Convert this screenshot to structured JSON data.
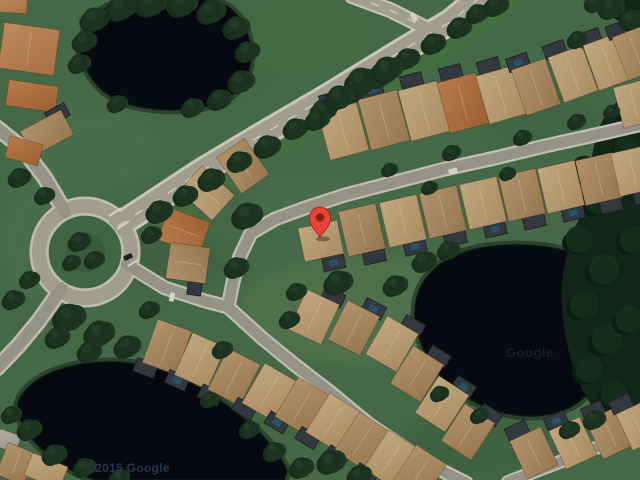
{
  "map": {
    "view_type": "satellite",
    "pin": {
      "x": 320,
      "y": 238,
      "color": "#EA4335",
      "dot_color": "#7E2217",
      "outline": "#9A2015"
    },
    "watermarks": [
      {
        "text": "©2015 Google",
        "x": 86,
        "y": 461,
        "size": 12,
        "weight": 600,
        "color": "#2b3a50",
        "opacity": 0.9,
        "ls": 0.3
      },
      {
        "text": "Google",
        "x": 506,
        "y": 345,
        "size": 13,
        "weight": 700,
        "color": "#22304a",
        "opacity": 0.55,
        "ls": 0.5
      }
    ],
    "palette": {
      "grass": "#4e7650",
      "belt": "#4a7d47",
      "water": "#070b13",
      "water_rim": "#1c2e20",
      "water_edge": "#0e1a12",
      "road_fill": "#b4b1a2",
      "road_edge": "#e0ddcf",
      "street_fill": "#a7a497",
      "street_edge": "#d6d3c5",
      "island": "#47724a",
      "island_inner": "#3f6743",
      "forest": "#142a1b",
      "tree1": "#1b3320",
      "tree2": "#224027",
      "tree3": "#1e3823",
      "tree_hi": "#2f5233",
      "forest1": "#0d2013",
      "forest2": "#122a19",
      "forest3": "#173320",
      "cage": "#383f45",
      "cage_edge": "#1f2429",
      "pool": "#2c6176",
      "car_white": "#eceade",
      "car_dark": "#23272b",
      "ridge": "rgba(255,246,224,0.3)",
      "roof_stroke": "rgba(70,45,20,0.4)",
      "marking": "#f2efe4",
      "roofs": {
        "tan": [
          "#d8bb8e",
          "#bf9d6e"
        ],
        "tan2": [
          "#c7a478",
          "#a9855a"
        ],
        "orange": [
          "#cf8a54",
          "#b06a38"
        ],
        "orange2": [
          "#d49a6a",
          "#bb7d4c"
        ],
        "pale": [
          "#c9c5b8",
          "#a9a497"
        ]
      }
    },
    "belt_path": "M 148,232 C 230,172 330,106 460,16 L 490,-2 L 524,-2 C 470,50 400,98 330,132 C 272,160 212,198 170,234 Z",
    "ponds": [
      {
        "name": "pond-northwest",
        "d": "M 80,52 C 82,24 98,6 126,1 L 210,0 C 232,4 246,20 250,44 C 253,68 246,90 222,101 C 198,112 160,112 132,105 C 106,98 88,82 80,52 Z"
      },
      {
        "name": "pond-east",
        "d": "M 419,291 C 428,268 452,252 487,247 C 522,242 562,246 590,260 C 612,272 620,295 616,322 C 612,352 604,380 582,399 C 560,418 524,420 494,410 C 462,399 436,377 424,350 C 414,327 412,310 419,291 Z"
      },
      {
        "name": "pond-southwest",
        "d": "M 20,398 C 34,374 72,361 114,362 C 158,363 200,384 238,414 C 262,433 280,453 287,471 L 284,480 L 96,480 C 62,470 38,448 27,432 C 18,419 15,408 20,398 Z"
      }
    ],
    "forest_paths": [
      "M 640,86 C 618,96 602,114 596,138 C 588,166 592,190 580,216 C 568,244 560,274 562,306 C 564,342 574,378 590,403 C 606,426 626,434 640,432 Z",
      "M 640,0 L 596,0 C 604,14 620,24 640,30 Z"
    ],
    "patches": [
      [
        90,
        150,
        70,
        40,
        "#58805a",
        0.45
      ],
      [
        165,
        262,
        60,
        32,
        "#3f6442",
        0.4
      ],
      [
        370,
        310,
        130,
        55,
        "#64885a",
        0.5
      ],
      [
        480,
        442,
        80,
        38,
        "#3c6340",
        0.4
      ],
      [
        240,
        432,
        70,
        32,
        "#47704a",
        0.4
      ],
      [
        200,
        60,
        80,
        40,
        "#49724b",
        0.4
      ],
      [
        45,
        240,
        45,
        60,
        "#5a815c",
        0.4
      ],
      [
        545,
        120,
        60,
        35,
        "#3f6b41",
        0.35
      ],
      [
        310,
        200,
        60,
        30,
        "#567e54",
        0.4
      ],
      [
        300,
        35,
        70,
        35,
        "#4d7a4b",
        0.5
      ]
    ],
    "roads": [
      {
        "name": "main-road",
        "pts": [
          [
            118,
            226
          ],
          [
            150,
            205
          ],
          [
            200,
            172
          ],
          [
            260,
            136
          ],
          [
            330,
            95
          ],
          [
            400,
            52
          ],
          [
            450,
            22
          ],
          [
            482,
            -4
          ]
        ],
        "w": 21,
        "uw": 27,
        "dash": true,
        "kind": "road"
      },
      {
        "name": "main-road-fork",
        "pts": [
          [
            352,
            -4
          ],
          [
            390,
            10
          ],
          [
            424,
            27
          ]
        ],
        "w": 12,
        "uw": 16,
        "dash": true,
        "kind": "road"
      },
      {
        "name": "northwest-road",
        "pts": [
          [
            -3,
            128
          ],
          [
            22,
            148
          ],
          [
            45,
            178
          ],
          [
            65,
            212
          ]
        ],
        "w": 12,
        "uw": 17,
        "dash": false,
        "kind": "street"
      },
      {
        "name": "southwest-road",
        "pts": [
          [
            62,
            288
          ],
          [
            38,
            322
          ],
          [
            18,
            346
          ],
          [
            -3,
            368
          ]
        ],
        "w": 12,
        "uw": 17,
        "dash": false,
        "kind": "street"
      },
      {
        "name": "east-street",
        "pts": [
          [
            126,
            264
          ],
          [
            165,
            288
          ],
          [
            205,
            301
          ],
          [
            228,
            307
          ],
          [
            262,
            338
          ],
          [
            295,
            365
          ],
          [
            330,
            392
          ],
          [
            370,
            425
          ],
          [
            410,
            452
          ],
          [
            448,
            474
          ],
          [
            466,
            483
          ]
        ],
        "w": 10.5,
        "uw": 15,
        "dash": false,
        "kind": "street"
      },
      {
        "name": "north-street",
        "pts": [
          [
            228,
            307
          ],
          [
            233,
            282
          ],
          [
            240,
            256
          ],
          [
            251,
            233
          ],
          [
            275,
            219
          ],
          [
            305,
            208
          ],
          [
            345,
            195
          ],
          [
            395,
            182
          ],
          [
            445,
            169
          ],
          [
            495,
            158
          ],
          [
            545,
            146
          ],
          [
            595,
            135
          ],
          [
            643,
            124
          ]
        ],
        "w": 10.5,
        "uw": 15,
        "dash": false,
        "kind": "street"
      },
      {
        "name": "corner-street",
        "pts": [
          [
            508,
            482
          ],
          [
            575,
            456
          ],
          [
            643,
            430
          ]
        ],
        "w": 10,
        "uw": 14,
        "dash": false,
        "kind": "street"
      }
    ],
    "roundabout": {
      "cx": 85,
      "cy": 252,
      "ring_r": 46,
      "ring_w": 14,
      "underlay_w": 19,
      "island_r": 37,
      "inner_r": 20
    },
    "crosswalks": [
      [
        109,
        216,
        121,
        208
      ],
      [
        117,
        229,
        129,
        221
      ],
      [
        128,
        266,
        138,
        260
      ]
    ],
    "houses": [
      [
        343,
        130,
        40,
        52,
        -15,
        "tan",
        -4,
        -32,
        0
      ],
      [
        384,
        120,
        40,
        52,
        -15,
        "tan2",
        -4,
        -32,
        1
      ],
      [
        424,
        111,
        40,
        52,
        -15,
        "tan",
        -4,
        -32,
        0
      ],
      [
        463,
        103,
        40,
        52,
        -15,
        "orange",
        -4,
        -32,
        0
      ],
      [
        501,
        95,
        38,
        50,
        -16,
        "tan",
        -4,
        -31,
        0
      ],
      [
        536,
        87,
        36,
        48,
        -19,
        "tan2",
        -9,
        -29,
        1
      ],
      [
        573,
        74,
        36,
        48,
        -20,
        "tan",
        -9,
        -29,
        0
      ],
      [
        608,
        62,
        36,
        48,
        -20,
        "tan",
        -9,
        -29,
        0
      ],
      [
        636,
        53,
        34,
        46,
        -21,
        "tan2",
        -9,
        -28,
        0
      ],
      [
        634,
        104,
        32,
        42,
        -15,
        "tan",
        null,
        null,
        0
      ],
      [
        321,
        241,
        40,
        34,
        -12,
        "tan",
        8,
        24,
        1
      ],
      [
        362,
        230,
        38,
        46,
        -13,
        "tan2",
        6,
        28,
        0
      ],
      [
        403,
        221,
        38,
        46,
        -13,
        "tan",
        6,
        28,
        1
      ],
      [
        443,
        212,
        38,
        46,
        -13,
        "tan2",
        6,
        28,
        0
      ],
      [
        483,
        203,
        38,
        46,
        -13,
        "tan",
        6,
        28,
        1
      ],
      [
        522,
        195,
        38,
        46,
        -13,
        "tan2",
        6,
        28,
        0
      ],
      [
        561,
        187,
        38,
        46,
        -13,
        "tan",
        6,
        28,
        1
      ],
      [
        599,
        179,
        38,
        46,
        -13,
        "tan2",
        6,
        28,
        0
      ],
      [
        633,
        171,
        36,
        44,
        -13,
        "tan",
        6,
        27,
        0
      ],
      [
        243,
        166,
        34,
        44,
        -35,
        "tan2",
        null,
        null,
        0
      ],
      [
        207,
        193,
        34,
        44,
        -48,
        "tan",
        null,
        null,
        0
      ],
      [
        184,
        231,
        34,
        44,
        -70,
        "orange",
        null,
        null,
        0
      ],
      [
        188,
        263,
        36,
        40,
        -82,
        "tan2",
        -20,
        10,
        0
      ],
      [
        314,
        317,
        36,
        44,
        25,
        "tan",
        9,
        -26,
        0
      ],
      [
        354,
        328,
        36,
        44,
        27,
        "tan2",
        9,
        -26,
        1
      ],
      [
        392,
        344,
        36,
        44,
        30,
        "tan",
        9,
        -26,
        0
      ],
      [
        417,
        374,
        36,
        44,
        32,
        "tan2",
        9,
        -26,
        0
      ],
      [
        442,
        404,
        36,
        44,
        33,
        "tan",
        9,
        -26,
        1
      ],
      [
        468,
        432,
        36,
        44,
        33,
        "tan2",
        9,
        -26,
        0
      ],
      [
        167,
        347,
        36,
        46,
        20,
        "tan2",
        -13,
        27,
        0
      ],
      [
        200,
        361,
        36,
        46,
        24,
        "tan",
        -13,
        27,
        1
      ],
      [
        234,
        377,
        36,
        46,
        27,
        "tan2",
        -13,
        27,
        0
      ],
      [
        269,
        392,
        36,
        46,
        30,
        "tan",
        -13,
        27,
        0
      ],
      [
        302,
        406,
        36,
        46,
        31,
        "tan2",
        -13,
        27,
        1
      ],
      [
        333,
        422,
        36,
        46,
        32,
        "tan",
        -13,
        27,
        0
      ],
      [
        362,
        441,
        36,
        46,
        33,
        "tan2",
        -13,
        27,
        0
      ],
      [
        391,
        459,
        36,
        46,
        33,
        "tan",
        -13,
        27,
        0
      ],
      [
        419,
        474,
        36,
        46,
        33,
        "tan2",
        null,
        null,
        0
      ],
      [
        534,
        453,
        34,
        42,
        -25,
        "tan2",
        -6,
        -27,
        0
      ],
      [
        573,
        443,
        34,
        42,
        -25,
        "tan",
        -6,
        -27,
        1
      ],
      [
        610,
        433,
        34,
        42,
        -25,
        "tan2",
        -6,
        -27,
        0
      ],
      [
        638,
        426,
        30,
        40,
        -25,
        "tan",
        -6,
        -27,
        0
      ],
      [
        29,
        49,
        56,
        46,
        8,
        "orange2",
        null,
        null,
        0
      ],
      [
        32,
        96,
        50,
        26,
        8,
        "orange",
        null,
        null,
        0
      ],
      [
        47,
        133,
        46,
        28,
        -28,
        "tan2",
        18,
        -12,
        0
      ],
      [
        24,
        151,
        34,
        22,
        15,
        "orange",
        null,
        null,
        0
      ],
      [
        13,
        6,
        28,
        14,
        4,
        "orange2",
        null,
        null,
        0
      ],
      [
        8,
        441,
        22,
        18,
        20,
        "pale",
        null,
        null,
        0
      ],
      [
        16,
        464,
        30,
        34,
        22,
        "tan2",
        null,
        null,
        0
      ],
      [
        46,
        471,
        38,
        24,
        22,
        "tan",
        null,
        null,
        0
      ]
    ],
    "trees": [
      [
        95,
        20,
        14
      ],
      [
        122,
        8,
        15
      ],
      [
        152,
        3,
        16
      ],
      [
        183,
        4,
        15
      ],
      [
        212,
        12,
        14
      ],
      [
        237,
        28,
        13
      ],
      [
        248,
        52,
        12
      ],
      [
        242,
        82,
        13
      ],
      [
        220,
        100,
        12
      ],
      [
        193,
        108,
        11
      ],
      [
        85,
        42,
        12
      ],
      [
        80,
        64,
        11
      ],
      [
        118,
        104,
        10
      ],
      [
        160,
        212,
        13
      ],
      [
        186,
        196,
        12
      ],
      [
        212,
        180,
        13
      ],
      [
        240,
        162,
        12
      ],
      [
        268,
        147,
        13
      ],
      [
        296,
        129,
        12
      ],
      [
        324,
        111,
        13
      ],
      [
        352,
        94,
        12
      ],
      [
        380,
        77,
        13
      ],
      [
        408,
        59,
        12
      ],
      [
        434,
        44,
        12
      ],
      [
        460,
        28,
        12
      ],
      [
        478,
        14,
        11
      ],
      [
        497,
        6,
        12
      ],
      [
        362,
        82,
        16
      ],
      [
        388,
        70,
        15
      ],
      [
        340,
        98,
        14
      ],
      [
        318,
        120,
        12
      ],
      [
        152,
        235,
        10
      ],
      [
        80,
        242,
        11
      ],
      [
        95,
        260,
        10
      ],
      [
        72,
        263,
        9
      ],
      [
        20,
        178,
        11
      ],
      [
        45,
        196,
        10
      ],
      [
        30,
        280,
        10
      ],
      [
        14,
        300,
        11
      ],
      [
        248,
        216,
        15
      ],
      [
        237,
        268,
        12
      ],
      [
        339,
        283,
        14
      ],
      [
        396,
        286,
        12
      ],
      [
        297,
        292,
        10
      ],
      [
        390,
        170,
        8
      ],
      [
        452,
        153,
        9
      ],
      [
        523,
        138,
        9
      ],
      [
        577,
        122,
        9
      ],
      [
        612,
        112,
        8
      ],
      [
        430,
        188,
        8
      ],
      [
        508,
        174,
        8
      ],
      [
        70,
        318,
        16
      ],
      [
        100,
        334,
        15
      ],
      [
        128,
        347,
        13
      ],
      [
        58,
        338,
        12
      ],
      [
        90,
        352,
        12
      ],
      [
        150,
        310,
        10
      ],
      [
        223,
        350,
        10
      ],
      [
        290,
        320,
        10
      ],
      [
        30,
        430,
        12
      ],
      [
        12,
        415,
        10
      ],
      [
        55,
        455,
        12
      ],
      [
        85,
        468,
        11
      ],
      [
        120,
        478,
        10
      ],
      [
        250,
        430,
        10
      ],
      [
        275,
        452,
        11
      ],
      [
        302,
        468,
        12
      ],
      [
        332,
        462,
        14
      ],
      [
        360,
        476,
        12
      ],
      [
        210,
        400,
        9
      ],
      [
        425,
        262,
        12
      ],
      [
        449,
        251,
        11
      ],
      [
        480,
        416,
        9
      ],
      [
        440,
        394,
        9
      ],
      [
        570,
        430,
        10
      ],
      [
        595,
        420,
        11
      ],
      [
        612,
        8,
        13
      ],
      [
        632,
        20,
        12
      ],
      [
        596,
        3,
        11
      ],
      [
        578,
        40,
        10
      ]
    ],
    "forest_blobs": [
      [
        585,
        170,
        16
      ],
      [
        600,
        200,
        18
      ],
      [
        580,
        240,
        16
      ],
      [
        605,
        270,
        18
      ],
      [
        585,
        305,
        17
      ],
      [
        608,
        340,
        18
      ],
      [
        590,
        370,
        16
      ],
      [
        615,
        395,
        16
      ],
      [
        628,
        150,
        15
      ],
      [
        634,
        112,
        13
      ],
      [
        622,
        428,
        13
      ],
      [
        634,
        240,
        16
      ],
      [
        630,
        320,
        16
      ]
    ],
    "cars": [
      [
        414,
        17,
        -33,
        "white"
      ],
      [
        128,
        257,
        65,
        "dark"
      ],
      [
        172,
        297,
        12,
        "white"
      ],
      [
        453,
        171,
        78,
        "white"
      ]
    ]
  }
}
